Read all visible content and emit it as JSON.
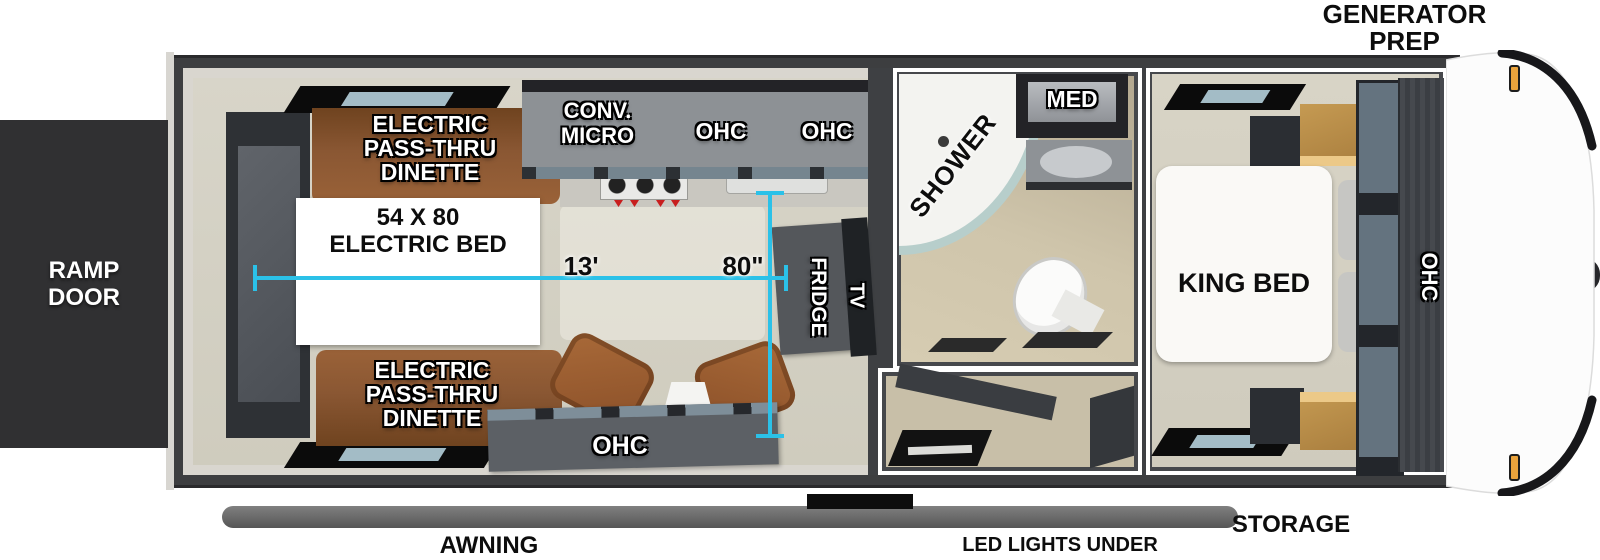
{
  "exterior": {
    "generator_prep": "GENERATOR PREP",
    "ramp_door": "RAMP DOOR",
    "awning": "AWNING",
    "led_lights": "LED LIGHTS UNDER AWNING",
    "storage": "STORAGE"
  },
  "living_area": {
    "dinette_top": "ELECTRIC PASS-THRU DINETTE",
    "dinette_bottom": "ELECTRIC PASS-THRU DINETTE",
    "electric_bed": "54 X 80 ELECTRIC BED",
    "conv_micro": "CONV. MICRO",
    "ohc_left": "OHC",
    "ohc_right": "OHC",
    "ohc_entertainment": "OHC",
    "fridge": "FRIDGE",
    "tv": "TV"
  },
  "bathroom": {
    "shower": "SHOWER",
    "med_cabinet": "MED"
  },
  "bedroom": {
    "king_bed": "KING BED",
    "ohc": "OHC"
  },
  "dimensions": {
    "garage_length": "13'",
    "garage_width": "80\""
  },
  "colors": {
    "dimension_line": "#2bc1e8",
    "body_wall": "#3d3e40",
    "floor": "#d4d0c2",
    "dinette_wood": "#8a5733",
    "cabinet_gray": "#8d9195",
    "accent_amber": "#eaa33c"
  }
}
